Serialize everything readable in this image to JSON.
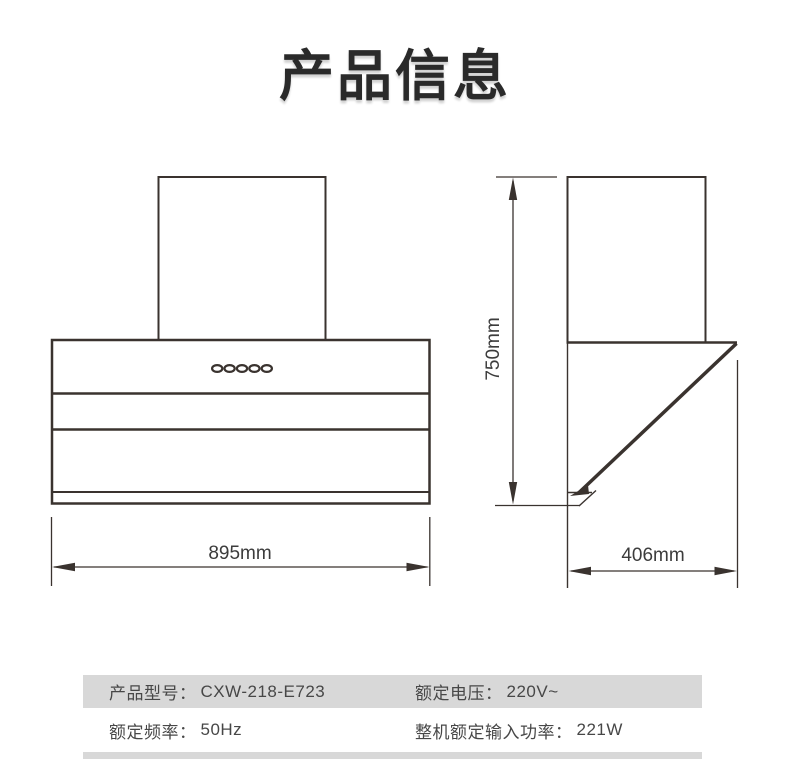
{
  "page": {
    "title": "产品信息"
  },
  "diagram": {
    "front_view": {
      "description": "range-hood-front-view",
      "width_dimension": "895mm",
      "control_buttons_count": 5
    },
    "side_view": {
      "description": "range-hood-side-view",
      "height_dimension": "750mm",
      "depth_dimension": "406mm"
    }
  },
  "spec_table": {
    "rows": [
      {
        "cells": [
          {
            "label": "产品型号：",
            "value": "CXW-218-E723"
          },
          {
            "label": "额定电压：",
            "value": "220V~"
          }
        ]
      },
      {
        "cells": [
          {
            "label": "额定频率：",
            "value": "50Hz"
          },
          {
            "label": "整机额定输入功率：",
            "value": "221W"
          }
        ]
      }
    ]
  },
  "colors": {
    "drawing_line": "#3a332f",
    "table_stripe": "#d8d8d8",
    "table_text": "#474747",
    "title_text": "#2a2a2a"
  }
}
